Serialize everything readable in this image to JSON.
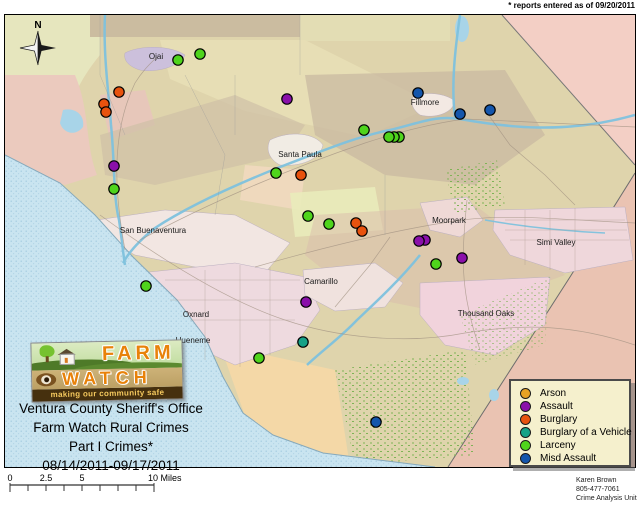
{
  "annotation": {
    "reports_note": "* reports entered as of 09/20/2011"
  },
  "compass": {
    "label": "N"
  },
  "map": {
    "cities": [
      {
        "name": "Ojai",
        "x": 151,
        "y": 44
      },
      {
        "name": "Fillmore",
        "x": 420,
        "y": 90
      },
      {
        "name": "Santa Paula",
        "x": 295,
        "y": 142
      },
      {
        "name": "San Buenaventura",
        "x": 148,
        "y": 218
      },
      {
        "name": "Moorpark",
        "x": 444,
        "y": 208
      },
      {
        "name": "Simi Valley",
        "x": 551,
        "y": 230
      },
      {
        "name": "Camarillo",
        "x": 316,
        "y": 269
      },
      {
        "name": "Oxnard",
        "x": 191,
        "y": 302
      },
      {
        "name": "Hueneme",
        "x": 188,
        "y": 328
      },
      {
        "name": "Thousand Oaks",
        "x": 481,
        "y": 301
      }
    ],
    "incidents": [
      {
        "type": "larceny",
        "x": 173,
        "y": 45
      },
      {
        "type": "larceny",
        "x": 195,
        "y": 39
      },
      {
        "type": "burglary",
        "x": 114,
        "y": 77
      },
      {
        "type": "burglary",
        "x": 99,
        "y": 89
      },
      {
        "type": "burglary",
        "x": 101,
        "y": 97
      },
      {
        "type": "assault",
        "x": 282,
        "y": 84
      },
      {
        "type": "misd_assault",
        "x": 413,
        "y": 78
      },
      {
        "type": "misd_assault",
        "x": 455,
        "y": 99
      },
      {
        "type": "misd_assault",
        "x": 485,
        "y": 95
      },
      {
        "type": "larceny",
        "x": 359,
        "y": 115
      },
      {
        "type": "larceny",
        "x": 394,
        "y": 122
      },
      {
        "type": "larceny",
        "x": 389,
        "y": 122
      },
      {
        "type": "larceny",
        "x": 384,
        "y": 122
      },
      {
        "type": "assault",
        "x": 109,
        "y": 151
      },
      {
        "type": "larceny",
        "x": 109,
        "y": 174
      },
      {
        "type": "larceny",
        "x": 271,
        "y": 158
      },
      {
        "type": "burglary",
        "x": 296,
        "y": 160
      },
      {
        "type": "larceny",
        "x": 303,
        "y": 201
      },
      {
        "type": "larceny",
        "x": 324,
        "y": 209
      },
      {
        "type": "burglary",
        "x": 351,
        "y": 208
      },
      {
        "type": "burglary",
        "x": 357,
        "y": 216
      },
      {
        "type": "assault",
        "x": 420,
        "y": 225
      },
      {
        "type": "assault",
        "x": 414,
        "y": 226
      },
      {
        "type": "assault",
        "x": 457,
        "y": 243
      },
      {
        "type": "larceny",
        "x": 431,
        "y": 249
      },
      {
        "type": "larceny",
        "x": 141,
        "y": 271
      },
      {
        "type": "assault",
        "x": 301,
        "y": 287
      },
      {
        "type": "burglary_vehicle",
        "x": 298,
        "y": 327
      },
      {
        "type": "larceny",
        "x": 254,
        "y": 343
      },
      {
        "type": "misd_assault",
        "x": 371,
        "y": 407
      }
    ]
  },
  "legend": {
    "items": [
      {
        "key": "arson",
        "label": "Arson",
        "color": "#E8A225"
      },
      {
        "key": "assault",
        "label": "Assault",
        "color": "#8A10AA"
      },
      {
        "key": "burglary",
        "label": "Burglary",
        "color": "#E8520E"
      },
      {
        "key": "burglary_vehicle",
        "label": "Burglary of a Vehicle",
        "color": "#17A287"
      },
      {
        "key": "larceny",
        "label": "Larceny",
        "color": "#4FD41C"
      },
      {
        "key": "misd_assault",
        "label": "Misd  Assault",
        "color": "#1456AC"
      }
    ]
  },
  "logo": {
    "farm": "FARM",
    "watch": "WATCH",
    "tagline": "making our community safe"
  },
  "title_block": {
    "line1": "Ventura County Sheriff's Office",
    "line2": "Farm Watch Rural Crimes",
    "line3": "Part I Crimes*",
    "line4": "08/14/2011-09/17/2011"
  },
  "scale_bar": {
    "labels": [
      "0",
      "2.5",
      "5",
      "10 Miles"
    ]
  },
  "credits": {
    "line1": "Karen Brown",
    "line2": "805-477-7061",
    "line3": "Crime Analysis Unit"
  }
}
